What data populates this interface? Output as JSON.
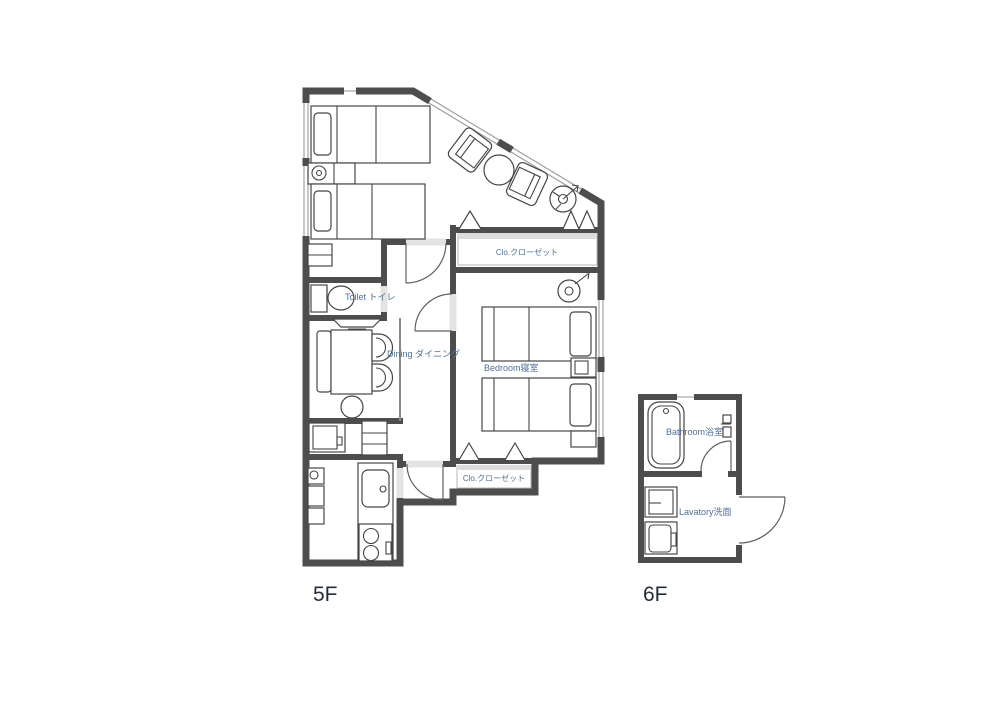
{
  "floors": {
    "f5": {
      "label": "5F",
      "rooms": {
        "toilet": "Toilet トイレ",
        "dining": "Dining ダイニング",
        "bedroom": "Bedroom寝室",
        "closet_upper": "Clo.クローゼット",
        "closet_lower": "Clo.クローゼット"
      }
    },
    "f6": {
      "label": "6F",
      "rooms": {
        "bathroom": "Bathroom浴室",
        "lavatory": "Lavatory洗面"
      }
    }
  },
  "colors": {
    "wall": "#4d4d4d",
    "furniture_line": "#454545",
    "room_label": "#4f7096",
    "floor_label": "#232d39",
    "opening": "#e3e3e3",
    "closet_band": "#dcdcdc",
    "page_bg": "#ffffff"
  }
}
